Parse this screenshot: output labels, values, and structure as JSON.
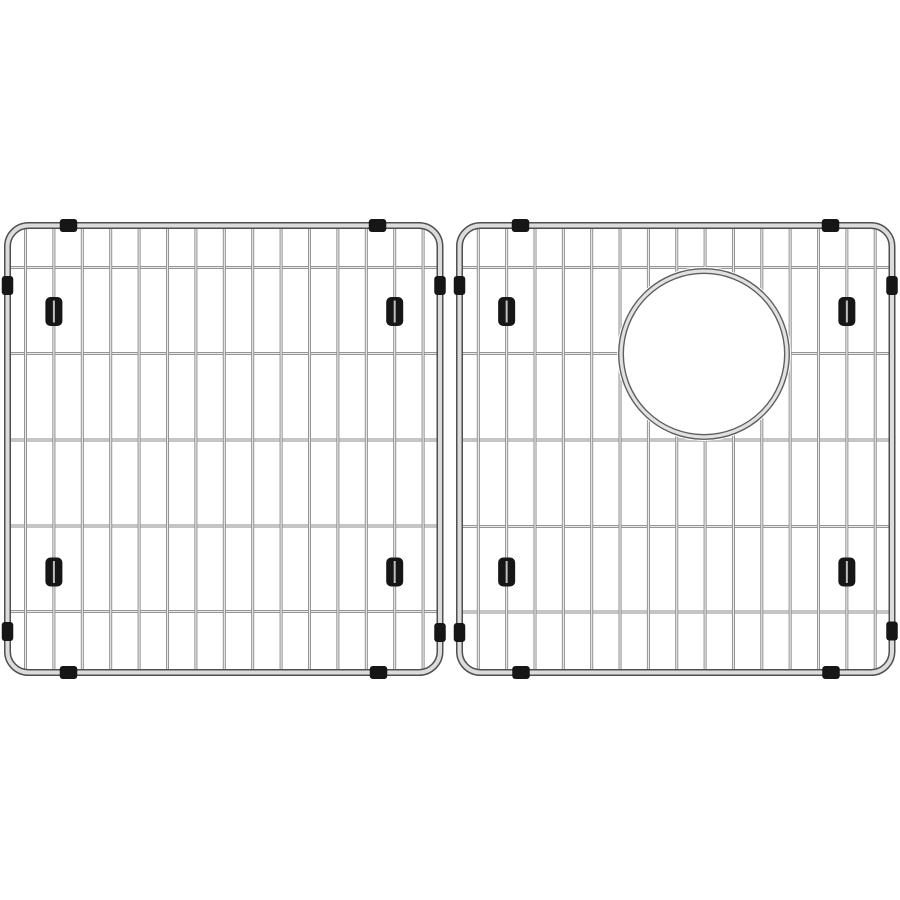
{
  "image": {
    "alt": "Two stainless steel wire sink bottom grids side by side with black corner bumpers and feet; the right grid has a round drain cutout",
    "background": "#ffffff",
    "canvas": {
      "width": 900,
      "height": 900
    }
  },
  "colors": {
    "frame_dark": "#4f4f4f",
    "frame_light": "#dcdcdc",
    "wire_dark": "#8a8a8a",
    "wire_light": "#eaeaea",
    "rim_dark": "#5f5f5f",
    "rim_light": "#e2e2e2",
    "rubber_black": "#161616",
    "foot_slit": "#bdbdbd"
  },
  "bumper_sizes": {
    "horizontal_edge": {
      "w": 17.5,
      "h": 13,
      "rx": 3
    },
    "vertical_edge": {
      "w": 11.5,
      "h": 19,
      "rx": 3
    },
    "foot": {
      "w": 17,
      "h": 29,
      "rx": 5
    }
  },
  "panels": [
    {
      "name": "left-grid",
      "frame": {
        "x": 4,
        "y": 222,
        "width": 439.5,
        "height": 454,
        "radius": 21,
        "tube": 7
      },
      "vertical_wires": {
        "count": 15,
        "start_x": 25.5,
        "spacing": 28.4
      },
      "horizontal_wires": {
        "ys": [
          267.5,
          353.5,
          440,
          526,
          611.5
        ]
      },
      "feet": [
        {
          "wire_index": 1,
          "y": 311.5
        },
        {
          "wire_index": 13,
          "y": 311.5
        },
        {
          "wire_index": 1,
          "y": 572
        },
        {
          "wire_index": 13,
          "y": 572
        }
      ],
      "edge_bumpers": {
        "top_x": [
          68.5,
          377.5
        ],
        "bottom_x": [
          68.5,
          378.5
        ],
        "left_y": [
          285.5,
          631.5
        ],
        "right_y": [
          285.5,
          632.5
        ]
      },
      "cutout": null
    },
    {
      "name": "right-grid",
      "frame": {
        "x": 456,
        "y": 222,
        "width": 439.5,
        "height": 454,
        "radius": 21,
        "tube": 7
      },
      "vertical_wires": {
        "count": 15,
        "start_x": 478.3,
        "spacing": 28.35
      },
      "horizontal_wires": {
        "ys": [
          267.5,
          353.5,
          440,
          526.5,
          612
        ]
      },
      "feet": [
        {
          "wire_index": 1,
          "y": 311.5
        },
        {
          "wire_index": 13,
          "y": 311.5
        },
        {
          "wire_index": 1,
          "y": 572
        },
        {
          "wire_index": 13,
          "y": 572
        }
      ],
      "edge_bumpers": {
        "top_x": [
          520.5,
          830.5
        ],
        "bottom_x": [
          521,
          831
        ],
        "left_y": [
          285.5,
          632.5
        ],
        "right_y": [
          285.5,
          631
        ]
      },
      "cutout": {
        "cx": 704,
        "cy": 354,
        "r": 83,
        "clear_r": 87
      }
    }
  ]
}
